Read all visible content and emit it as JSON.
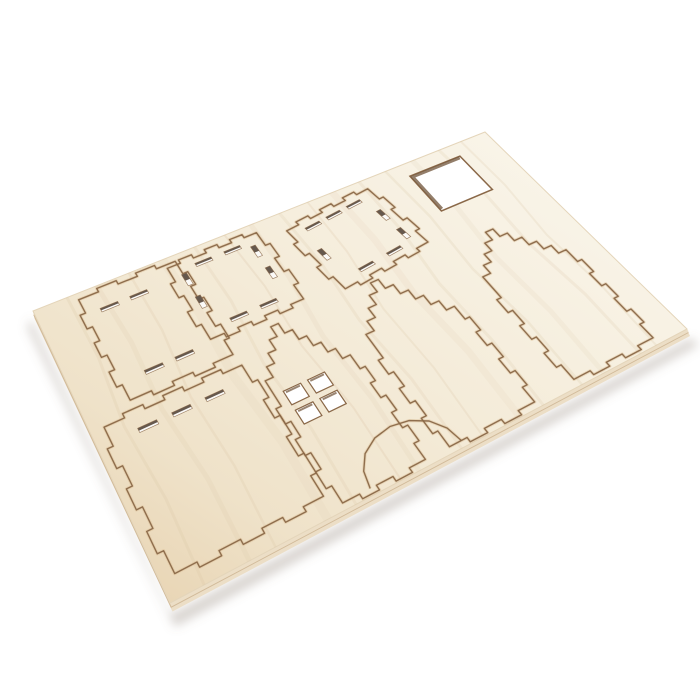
{
  "scene": {
    "width": 700,
    "height": 700,
    "background": "#ffffff",
    "subject": "laser-cut plywood house kit sheet"
  },
  "sheet": {
    "name": "plywood-sheet",
    "flat_size": [
      600,
      400
    ],
    "corners_screen": {
      "top_left": [
        33,
        311
      ],
      "top_right": [
        485,
        132
      ],
      "bottom_right": [
        687,
        329
      ],
      "bottom_left": [
        170,
        603
      ]
    },
    "colors": {
      "face_gradient": [
        [
          "0%",
          "#f9f4e8"
        ],
        [
          "45%",
          "#f4ebd8"
        ],
        [
          "78%",
          "#efe2c9"
        ],
        [
          "100%",
          "#e9d6b6"
        ]
      ],
      "face_edge_hairline": "#e4d5ba",
      "edge_band": "#e2d2b5",
      "edge_band_light": "#ecdec6",
      "edge_top": "#efe3cd",
      "edge_seam": "#cdb492",
      "cut_line": "#8a6848",
      "cut_glow": "#d9ba8e",
      "slot_dark": "#584a3e",
      "slot_light": "#fbfaf8",
      "hole_wall": "#6f5338",
      "hole_fill": "#ffffff",
      "grain": "#d9c2a2",
      "shadow": "rgba(128,116,98,0.30)"
    }
  },
  "pieces": [
    {
      "name": "side-panel-upper-left",
      "start": [
        48,
        10
      ],
      "segments": [
        {
          "to": [
            162,
            10
          ],
          "tabs": 2,
          "depth": 6
        },
        {
          "to": [
            162,
            172
          ],
          "tabs": 3,
          "depth": 6
        },
        {
          "to": [
            48,
            172
          ],
          "tabs": 2,
          "depth": 6
        },
        {
          "to": [
            48,
            10
          ],
          "tabs": 3,
          "depth": 6
        }
      ]
    },
    {
      "name": "side-panel-lower-left",
      "start": [
        14,
        190
      ],
      "segments": [
        {
          "to": [
            164,
            190
          ],
          "tabs": 3,
          "depth": 6
        },
        {
          "to": [
            164,
            376
          ],
          "tabs": 3,
          "depth": 6
        },
        {
          "to": [
            14,
            376
          ],
          "tabs": 3,
          "depth": 6
        },
        {
          "to": [
            14,
            190
          ],
          "tabs": 3,
          "depth": 6
        }
      ]
    },
    {
      "name": "roof-panel-small",
      "start": [
        150,
        16
      ],
      "segments": [
        {
          "to": [
            262,
            16
          ],
          "tabs": 3,
          "depth": 6
        },
        {
          "to": [
            262,
            140
          ],
          "tabs": 2,
          "depth": 6
        },
        {
          "to": [
            150,
            140
          ],
          "tabs": 3,
          "depth": 6
        },
        {
          "to": [
            150,
            16
          ],
          "tabs": 2,
          "depth": 6
        }
      ]
    },
    {
      "name": "roof-panel-large",
      "start": [
        294,
        32
      ],
      "segments": [
        {
          "to": [
            413,
            17
          ],
          "tabs": 3,
          "depth": 6
        },
        {
          "to": [
            428,
            136
          ],
          "tabs": 2,
          "depth": 6
        },
        {
          "to": [
            309,
            151
          ],
          "tabs": 3,
          "depth": 6
        },
        {
          "to": [
            294,
            32
          ],
          "tabs": 2,
          "depth": 6
        }
      ]
    },
    {
      "name": "house-front-facade",
      "start": [
        176,
        238
      ],
      "segments": [
        {
          "to": [
            222,
            158
          ],
          "steps": 5
        },
        {
          "to": [
            268,
            238
          ],
          "steps": 5
        },
        {
          "to": [
            268,
            392
          ],
          "tabs": 3,
          "depth": 6
        },
        {
          "to": [
            176,
            392
          ],
          "tabs": 2,
          "depth": 6
        },
        {
          "to": [
            176,
            238
          ],
          "tabs": 3,
          "depth": 6
        }
      ]
    },
    {
      "name": "gable-end-panel-middle",
      "start": [
        296,
        238
      ],
      "segments": [
        {
          "to": [
            348,
            158
          ],
          "steps": 5
        },
        {
          "to": [
            400,
            238
          ],
          "steps": 5
        },
        {
          "to": [
            400,
            392
          ],
          "tabs": 3,
          "depth": 6
        },
        {
          "to": [
            296,
            392
          ],
          "tabs": 2,
          "depth": 6
        },
        {
          "to": [
            296,
            238
          ],
          "tabs": 3,
          "depth": 6
        }
      ]
    },
    {
      "name": "gable-end-panel-right",
      "start": [
        452,
        232
      ],
      "segments": [
        {
          "to": [
            506,
            158
          ],
          "steps": 5
        },
        {
          "to": [
            560,
            232
          ],
          "steps": 5
        },
        {
          "to": [
            560,
            390
          ],
          "tabs": 3,
          "depth": 6
        },
        {
          "to": [
            452,
            390
          ],
          "tabs": 2,
          "depth": 6
        },
        {
          "to": [
            452,
            232
          ],
          "tabs": 3,
          "depth": 6
        }
      ]
    }
  ],
  "holes": {
    "square_cutout": {
      "name": "square-cutout",
      "rect": [
        470,
        24,
        75,
        75
      ]
    },
    "window_panes": {
      "name": "window-cutout",
      "panes": [
        [
          186,
          244,
          20,
          20
        ],
        [
          214,
          244,
          20,
          20
        ],
        [
          186,
          272,
          20,
          20
        ],
        [
          214,
          272,
          20,
          20
        ]
      ]
    },
    "door_arch": {
      "name": "door-arch-cutout",
      "points": [
        [
          206,
          392
        ],
        [
          210,
          372
        ],
        [
          221,
          355
        ],
        [
          238,
          344
        ],
        [
          258,
          340
        ],
        [
          278,
          344
        ],
        [
          295,
          355
        ],
        [
          306,
          372
        ],
        [
          310,
          392
        ]
      ]
    }
  },
  "slots": [
    [
      74,
      38,
      20,
      6,
      0
    ],
    [
      108,
      38,
      20,
      6,
      0
    ],
    [
      84,
      146,
      20,
      6,
      0
    ],
    [
      118,
      146,
      20,
      6,
      0
    ],
    [
      52,
      212,
      20,
      6,
      0
    ],
    [
      88,
      212,
      20,
      6,
      0
    ],
    [
      124,
      212,
      20,
      6,
      0
    ],
    [
      163,
      44,
      6,
      20,
      0
    ],
    [
      163,
      84,
      6,
      20,
      0
    ],
    [
      249,
      44,
      6,
      20,
      0
    ],
    [
      249,
      84,
      6,
      20,
      0
    ],
    [
      190,
      28,
      20,
      6,
      0
    ],
    [
      226,
      28,
      20,
      6,
      0
    ],
    [
      190,
      126,
      20,
      6,
      0
    ],
    [
      226,
      126,
      20,
      6,
      0
    ],
    [
      325,
      41,
      20,
      6,
      -7
    ],
    [
      355,
      37,
      20,
      6,
      -7
    ],
    [
      385,
      33,
      20,
      6,
      -7
    ],
    [
      347,
      133,
      20,
      6,
      -7
    ],
    [
      387,
      128,
      20,
      6,
      -7
    ],
    [
      406,
      68,
      6,
      20,
      -7
    ],
    [
      411,
      108,
      6,
      20,
      -7
    ],
    [
      314,
      90,
      6,
      20,
      -7
    ]
  ],
  "grain_streaks": [
    {
      "u": 38,
      "du": -6,
      "w": 3,
      "o": 0.2
    },
    {
      "u": 72,
      "du": 4,
      "w": 5,
      "o": 0.15
    },
    {
      "u": 110,
      "du": -8,
      "w": 2.5,
      "o": 0.22
    },
    {
      "u": 150,
      "du": 6,
      "w": 9,
      "o": 0.1
    },
    {
      "u": 190,
      "du": -4,
      "w": 3,
      "o": 0.18
    },
    {
      "u": 228,
      "du": 8,
      "w": 2,
      "o": 0.24
    },
    {
      "u": 262,
      "du": -6,
      "w": 5,
      "o": 0.13
    },
    {
      "u": 300,
      "du": 5,
      "w": 3,
      "o": 0.18
    },
    {
      "u": 338,
      "du": -7,
      "w": 2,
      "o": 0.22
    },
    {
      "u": 372,
      "du": 4,
      "w": 7,
      "o": 0.11
    },
    {
      "u": 410,
      "du": -5,
      "w": 3,
      "o": 0.18
    },
    {
      "u": 448,
      "du": 7,
      "w": 2.5,
      "o": 0.2
    },
    {
      "u": 488,
      "du": -4,
      "w": 5,
      "o": 0.12
    },
    {
      "u": 528,
      "du": 6,
      "w": 3,
      "o": 0.18
    },
    {
      "u": 562,
      "du": -6,
      "w": 2,
      "o": 0.2
    }
  ]
}
